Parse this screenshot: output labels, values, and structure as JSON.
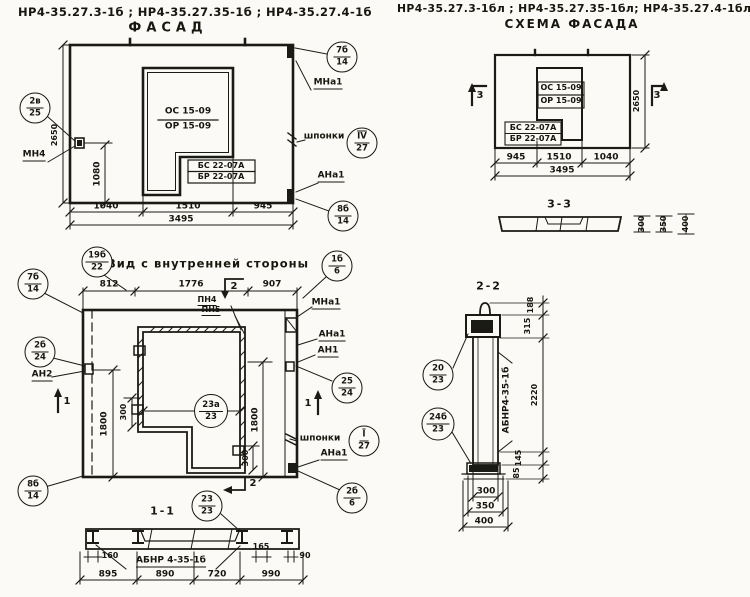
{
  "header": {
    "left_marks": "НР4-35.27.3-1б ;  НР4-35.27.35-1б ;  НР4-35.27.4-1б",
    "left_title": "ФАСАД",
    "right_marks": "НР4-35.27.3-1бл ;  НР4-35.27.35-1бл;  НР4-35.27.4-1бл",
    "right_title": "СХЕМА ФАСАДА"
  },
  "facade": {
    "window": {
      "os": "ОС 15-09",
      "or": "ОР 15-09",
      "bs": "БС 22-07А",
      "br": "БР 22-07А"
    },
    "dims": {
      "w1": "1040",
      "w2": "1510",
      "w3": "945",
      "total": "3495",
      "height": "2650",
      "v": "1080"
    },
    "labels": {
      "mn4": "МН4",
      "mna1": "МНа1",
      "shponki": "шпонки",
      "ana1": "АНа1"
    },
    "callouts": {
      "left": {
        "top": "2в",
        "bottom": "25"
      },
      "top_right": {
        "top": "7б",
        "bottom": "14"
      },
      "keys": {
        "top": "IV",
        "bottom": "27"
      },
      "bottom_right": {
        "top": "8б",
        "bottom": "14"
      }
    }
  },
  "schema": {
    "window": {
      "os": "ОС 15-09",
      "or": "ОР 15-09",
      "bs": "БС 22-07А",
      "br": "БР 22-07А"
    },
    "dims": {
      "w1": "945",
      "w2": "1510",
      "w3": "1040",
      "total": "3495",
      "height": "2650"
    },
    "marker": "3",
    "section33": {
      "title": "3-3",
      "d1": "300",
      "d2": "350",
      "d3": "400"
    }
  },
  "inner": {
    "title": "Вид с внутренней стороны",
    "dims": {
      "t1": "812",
      "t2": "1776",
      "t3": "907",
      "v1": "1800",
      "v2": "1800",
      "n1": "300",
      "n2": "300"
    },
    "labels": {
      "pn4": "ПН4",
      "pn5": "ПН5",
      "mna1": "МНа1",
      "ana1_top": "АНа1",
      "an1": "АН1",
      "shponki": "шпонки",
      "ana1_bot": "АНа1",
      "an2": "АН2"
    },
    "markers": {
      "m1": "1",
      "m2": "2"
    },
    "callouts": {
      "title_left": {
        "top": "19б",
        "bottom": "22"
      },
      "title_right": {
        "top": "1б",
        "bottom": "6"
      },
      "top_left": {
        "top": "7б",
        "bottom": "14"
      },
      "left": {
        "top": "2б",
        "bottom": "24"
      },
      "bottom_left": {
        "top": "8б",
        "bottom": "14"
      },
      "right": {
        "top": "25",
        "bottom": "24"
      },
      "keys": {
        "top": "I",
        "bottom": "27"
      },
      "bottom_right": {
        "top": "2б",
        "bottom": "6"
      },
      "center": {
        "top": "23а",
        "bottom": "23"
      },
      "below": {
        "top": "23",
        "bottom": "23"
      }
    }
  },
  "section11": {
    "title": "1-1",
    "label": "АБНР 4-35-1б",
    "dims": {
      "a": "160",
      "b": "165",
      "c": "90",
      "w1": "895",
      "w2": "890",
      "w3": "720",
      "w4": "990"
    }
  },
  "section22": {
    "title": "2-2",
    "label": "АБНР4-35-1б",
    "dims": {
      "d1": "188",
      "d2": "315",
      "d3": "2220",
      "d4": "145",
      "d5": "85",
      "b1": "300",
      "b2": "350",
      "b3": "400"
    },
    "callouts": {
      "top": {
        "top": "20",
        "bottom": "23"
      },
      "bottom": {
        "top": "24б",
        "bottom": "23"
      }
    }
  }
}
